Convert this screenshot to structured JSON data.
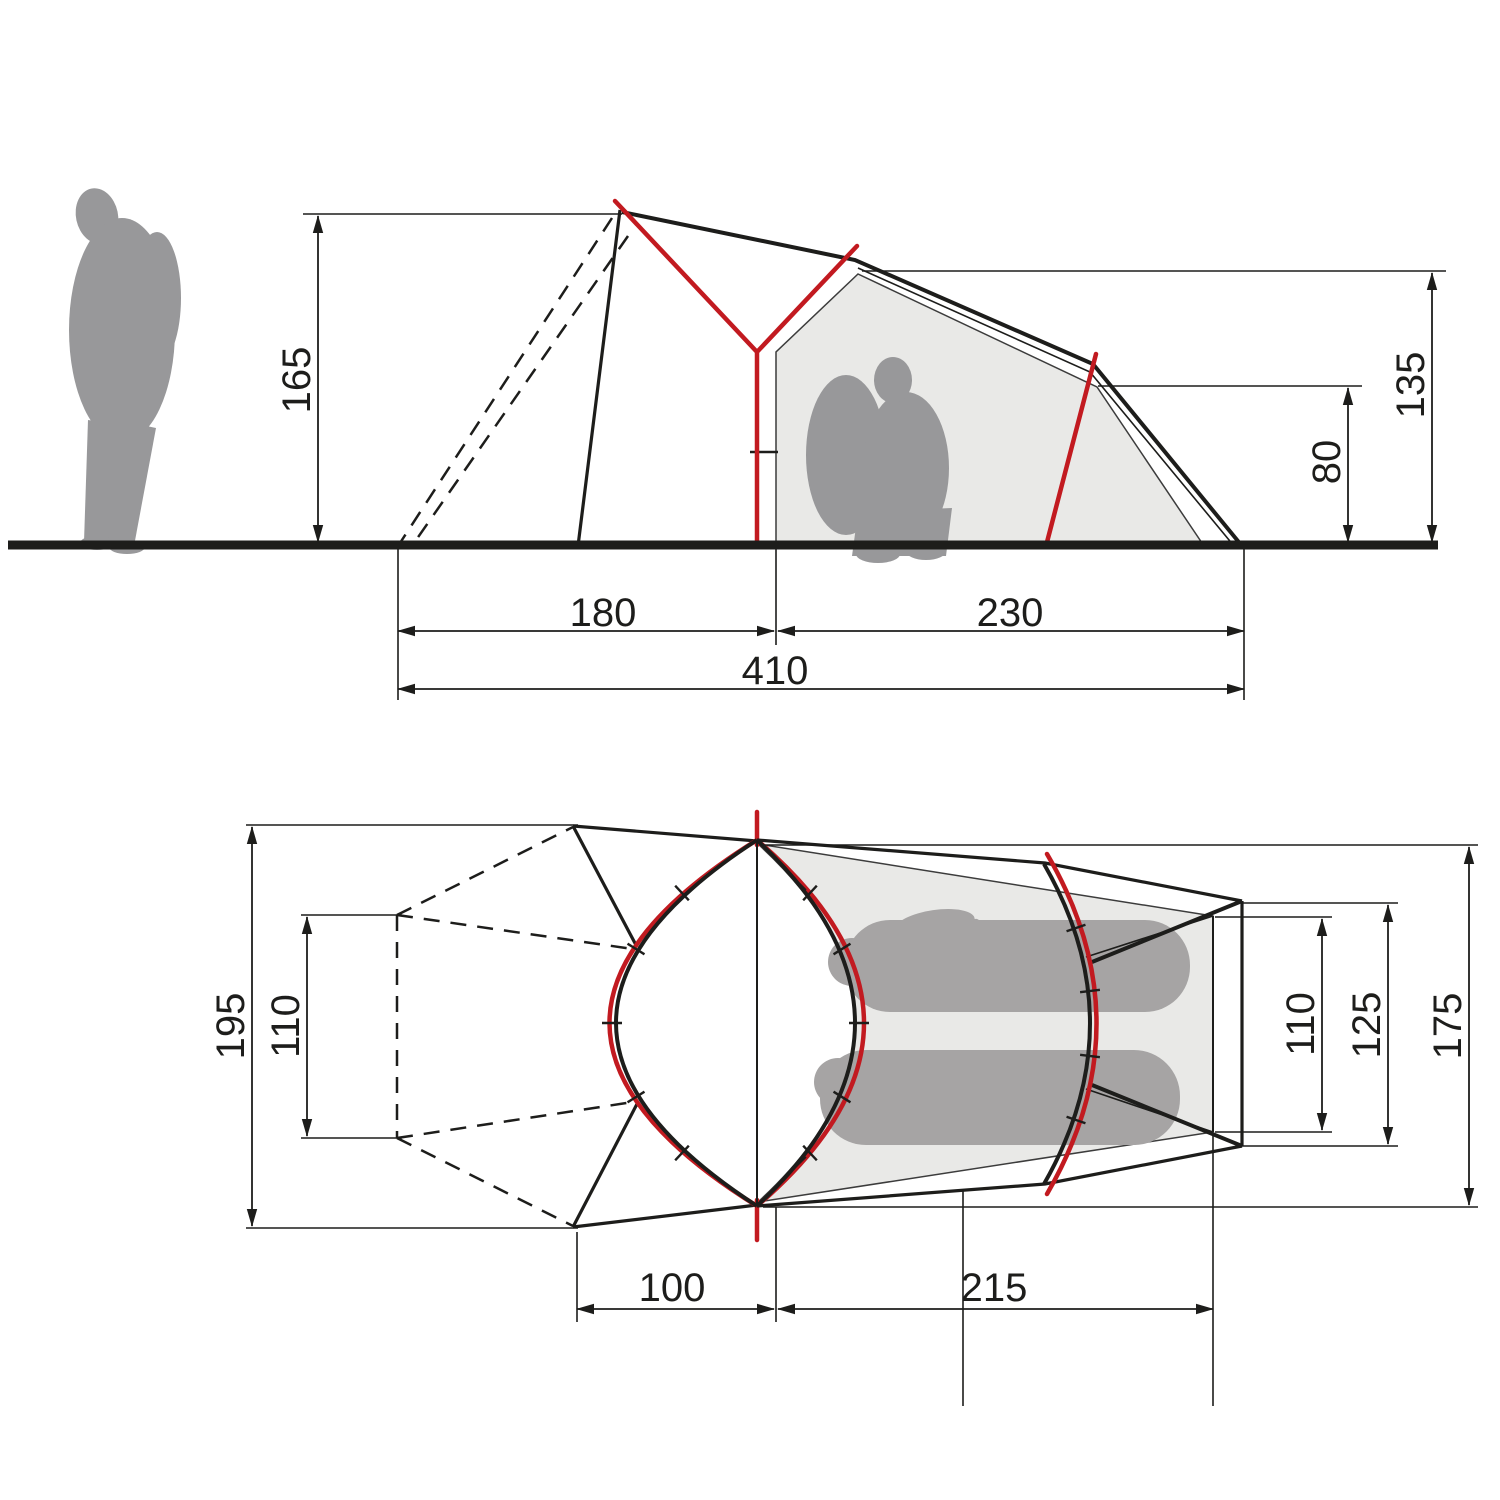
{
  "diagram": {
    "kind": "tent-dimension-drawing",
    "colors": {
      "line_black": "#1d1d1b",
      "pole_red": "#c21a20",
      "figure_gray": "#98989a",
      "inner_tent_fill": "#e9e9e7"
    },
    "side_view": {
      "dims": {
        "front_peak_height": "165",
        "inner_peak_height": "135",
        "rear_height": "80",
        "vestibule_length": "180",
        "inner_length": "230",
        "total_length": "410"
      }
    },
    "top_view": {
      "dims": {
        "total_width": "195",
        "front_entry_width": "110",
        "rear_inner_width": "110",
        "rear_outer_width": "125",
        "inner_max_width": "175",
        "vestibule_depth": "100",
        "inner_floor_length": "215"
      }
    }
  }
}
